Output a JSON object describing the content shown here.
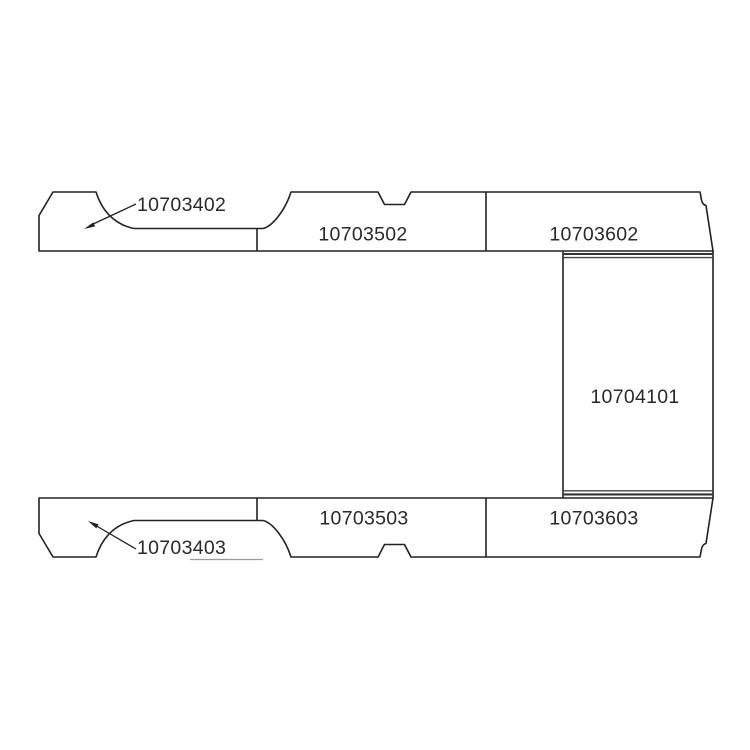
{
  "diagram": {
    "kind": "exploded-parts-diagram",
    "subject": "van-floor-panels",
    "background": "#ffffff",
    "line_color": "#222222",
    "parts": {
      "top_left": {
        "label": "10703402"
      },
      "top_middle": {
        "label": "10703502"
      },
      "top_right": {
        "label": "10703602"
      },
      "center_right": {
        "label": "10704101"
      },
      "bottom_left": {
        "label": "10703403"
      },
      "bottom_middle": {
        "label": "10703503"
      },
      "bottom_right": {
        "label": "10703603"
      }
    }
  }
}
